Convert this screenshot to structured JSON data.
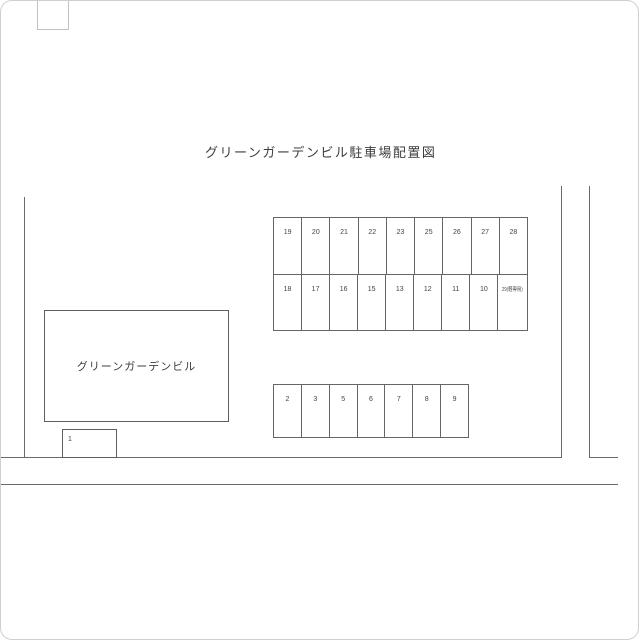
{
  "title": "グリーンガーデンビル駐車場配置図",
  "building": {
    "label": "グリーンガーデンビル"
  },
  "space_1": {
    "label": "1"
  },
  "upper_grid": {
    "row_a": [
      "19",
      "20",
      "21",
      "22",
      "23",
      "25",
      "26",
      "27",
      "28"
    ],
    "row_b": [
      "18",
      "17",
      "16",
      "15",
      "13",
      "12",
      "11",
      "10",
      "29(軽専用)"
    ]
  },
  "lower_row": [
    "2",
    "3",
    "5",
    "6",
    "7",
    "8",
    "9"
  ],
  "colors": {
    "line": "#6a6a6a",
    "text": "#3d3d3d",
    "card_border": "#cfcfcf"
  }
}
